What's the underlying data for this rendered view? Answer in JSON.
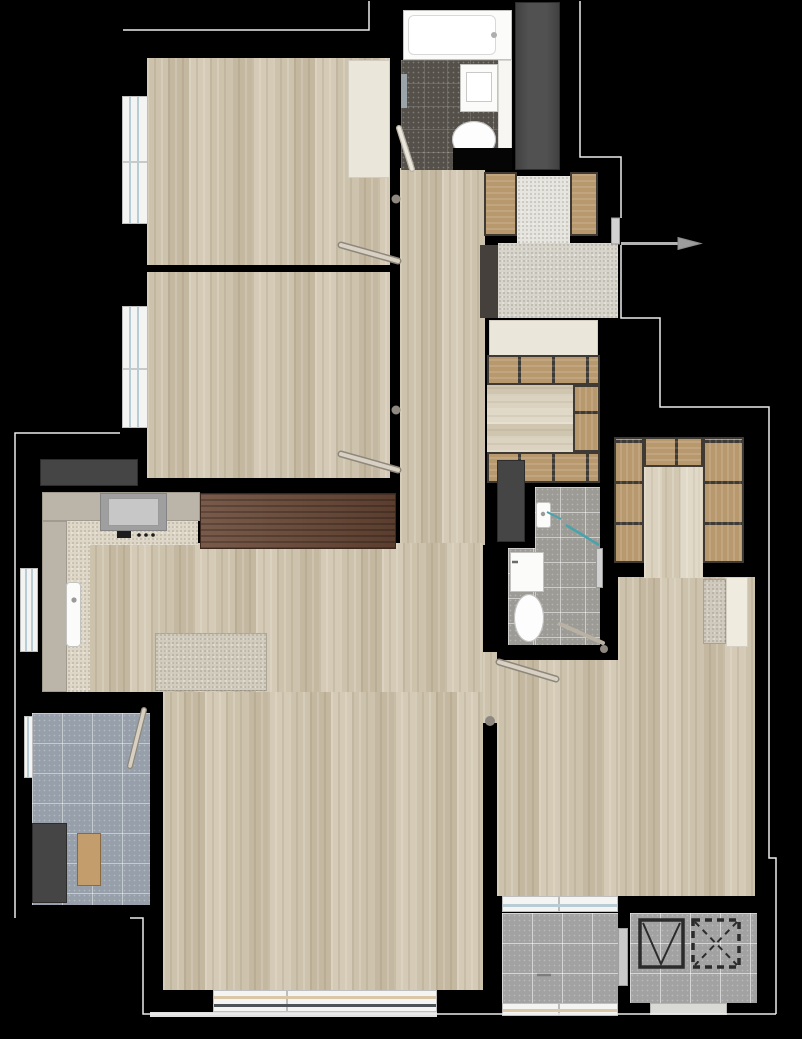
{
  "app": {
    "type": "apartment-floor-plan",
    "visible_text": [],
    "north_indicator": "none",
    "entrance_marker": "arrow-right-at-front-door"
  },
  "palette": {
    "background": "#000000",
    "wall": "#050505",
    "wood_floor": "#cdc2ac",
    "pale_wood": "#dbd2bf",
    "kitchen_floor_speckle": "#ded7c7",
    "entry_granite": "#d7d4cc",
    "entry_landing": "#e6e4de",
    "counter_gray": "#bab5a8",
    "walnut_cabinet": "#6a4836",
    "cream_builtin": "#eae6da",
    "appliance_dark": "#454545",
    "shaft_gray": "#474747",
    "bath_dark_tile": "#55504a",
    "bath_gray_tile": "#9d9b96",
    "utility_tile": "#97a0aa",
    "balcony_tile": "#a2a2a2",
    "shelf_wood": "#b8996e",
    "window_glass_blue": "#b7ccd4",
    "window_glass_tan": "#d9c7a8",
    "glass_partition_teal": "#49a3ad",
    "outline_white": "#ececec",
    "fixture_white": "#fbfbfa",
    "door_leaf": "#d8d1c3"
  },
  "rooms": [
    {
      "name": "bedroom-upper-left"
    },
    {
      "name": "bedroom-middle-left"
    },
    {
      "name": "bathroom-top"
    },
    {
      "name": "entry-foyer"
    },
    {
      "name": "hallway"
    },
    {
      "name": "corridor-wardrobe"
    },
    {
      "name": "kitchen"
    },
    {
      "name": "living-dining-room"
    },
    {
      "name": "utility-balcony"
    },
    {
      "name": "bathroom-middle"
    },
    {
      "name": "walk-in-closet"
    },
    {
      "name": "bedroom-lower-right"
    },
    {
      "name": "rear-balcony"
    },
    {
      "name": "elevator-hall"
    }
  ],
  "fixtures": [
    "bathtub",
    "toilet",
    "washbasin",
    "toilet-tank",
    "kitchen-sink",
    "cooktop",
    "range-icon",
    "refrigerator",
    "washing-machine",
    "dining-table",
    "walnut-sideboard",
    "built-in-closet",
    "shoe-cabinet",
    "console-shelf",
    "desk",
    "elevator-cab",
    "shaft-void",
    "entrance-arrow",
    "door-swing",
    "shower-glass-partition",
    "window",
    "towel-bar",
    "service-shaft"
  ]
}
